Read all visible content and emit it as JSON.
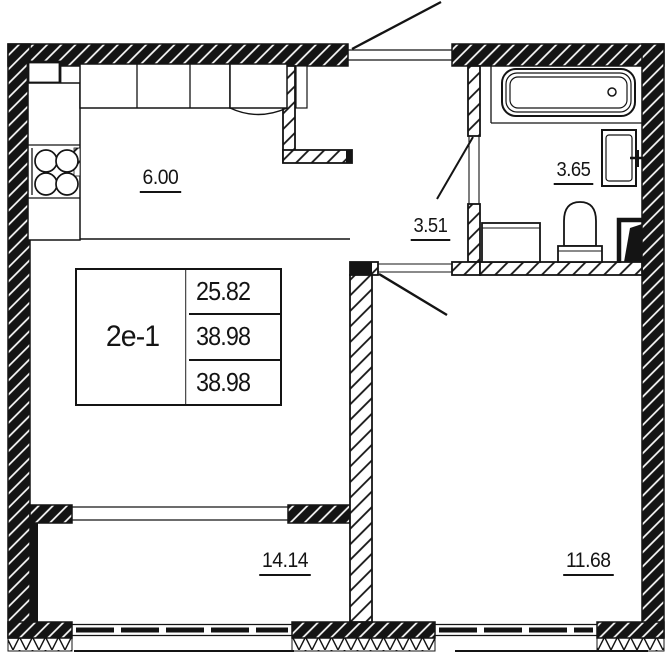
{
  "unit": {
    "label": "2е-1",
    "area_rows": [
      "25.82",
      "38.98",
      "38.98"
    ]
  },
  "rooms": {
    "kitchen_living": "6.00",
    "hallway": "3.51",
    "bathroom": "3.65",
    "living_room": "14.14",
    "bedroom": "11.68"
  },
  "icons": [
    "bathtub-icon",
    "sink-icon",
    "toilet-icon",
    "washing-machine-icon",
    "stove-icon",
    "kitchen-cabinet-icon",
    "door-swing-icon",
    "window-icon",
    "vent-shaft-icon",
    "wall-hatch-pattern",
    "insulation-zigzag-pattern"
  ],
  "colors": {
    "line": "#141414",
    "background": "#ffffff"
  }
}
